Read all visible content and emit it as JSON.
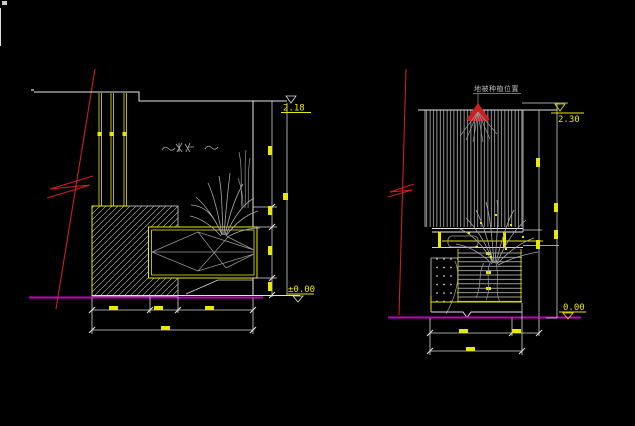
{
  "canvas": {
    "background": "#000000",
    "kind": "cad-elevation-drawing"
  },
  "colors": {
    "line_white": "#e6e6e6",
    "detail_gray": "#a8a8a8",
    "accent_yellow": "#e8e800",
    "section_red": "#cc2020",
    "ground_magenta": "#c400c4"
  },
  "left_view": {
    "level_top": "2.18",
    "level_bottom": "±0.00"
  },
  "right_view": {
    "level_top": "2.30",
    "level_bottom": "0.00",
    "plant_label": "地被种植位置"
  }
}
